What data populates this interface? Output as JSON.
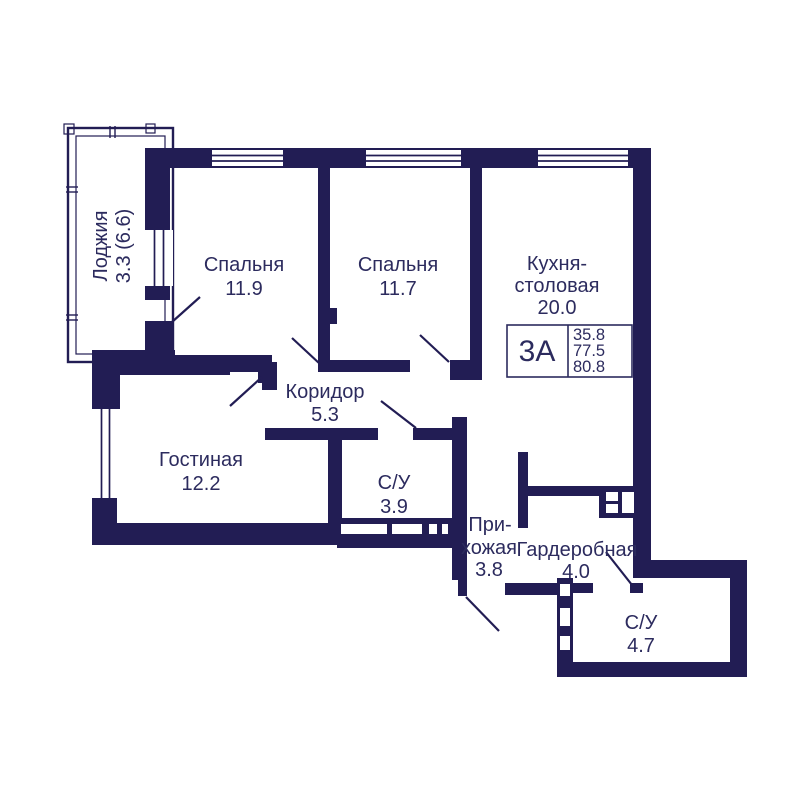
{
  "plan": {
    "colors": {
      "wall": "#221d54",
      "text": "#2c2b5e"
    },
    "loggia": {
      "label": "Лоджия",
      "area": "3.3 (6.6)"
    },
    "bedroom1": {
      "label": "Спальня",
      "area": "11.9"
    },
    "bedroom2": {
      "label": "Спальня",
      "area": "11.7"
    },
    "kitchen": {
      "label1": "Кухня-",
      "label2": "столовая",
      "area": "20.0"
    },
    "corridor": {
      "label": "Коридор",
      "area": "5.3"
    },
    "living": {
      "label": "Гостиная",
      "area": "12.2"
    },
    "bathroom1": {
      "label": "С/У",
      "area": "3.9"
    },
    "hallway": {
      "label1": "При-",
      "label2": "хожая",
      "area": "3.8"
    },
    "wardrobe": {
      "label": "Гардеробная",
      "area": "4.0"
    },
    "bathroom2": {
      "label": "С/У",
      "area": "4.7"
    },
    "info_box": {
      "type": "3А",
      "area_living": "35.8",
      "area_main": "77.5",
      "area_total": "80.8"
    }
  }
}
